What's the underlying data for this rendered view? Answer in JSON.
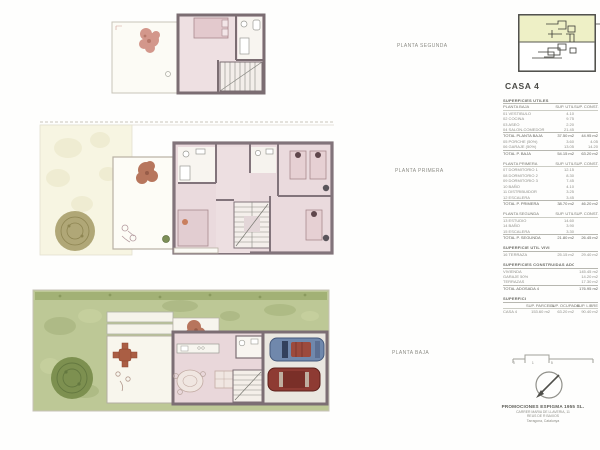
{
  "title": "CASA 4",
  "labels": {
    "planta_segunda": "PLANTA SEGUNDA",
    "planta_primera": "PLANTA PRIMERA",
    "planta_baja": "PLANTA BAJA"
  },
  "areas_table": {
    "sections": [
      {
        "rows": [
          {
            "t": "h",
            "c": [
              "SUPERFICIES UTILES CASA 4",
              "",
              ""
            ]
          },
          {
            "t": "c",
            "c": [
              "PLANTA BAJA",
              "SUP. UTIL",
              "SUP. CONST."
            ]
          },
          {
            "t": "r",
            "c": [
              "01 VESTIBULO",
              "4.10",
              ""
            ]
          },
          {
            "t": "r",
            "c": [
              "02 COCINA",
              "9.75",
              ""
            ]
          },
          {
            "t": "r",
            "c": [
              "03 ASEO",
              "2.20",
              ""
            ]
          },
          {
            "t": "r",
            "c": [
              "04 SALON-COMEDOR",
              "21.45",
              ""
            ]
          },
          {
            "t": "t",
            "c": [
              "TOTAL PLANTA BAJA",
              "37.50 m2",
              "44.95 m2"
            ]
          },
          {
            "t": "r",
            "c": [
              "05 PORCHE (50%)",
              "3.60",
              "4.05"
            ]
          },
          {
            "t": "r",
            "c": [
              "06 GARAJE (50%)",
              "13.05",
              "14.20"
            ]
          },
          {
            "t": "t",
            "c": [
              "TOTAL P. BAJA",
              "54.15 m2",
              "63.20 m2"
            ]
          }
        ]
      },
      {
        "rows": [
          {
            "t": "c",
            "c": [
              "PLANTA PRIMERA",
              "SUP. UTIL",
              "SUP. CONST."
            ]
          },
          {
            "t": "r",
            "c": [
              "07 DORMITORIO 1",
              "12.15",
              ""
            ]
          },
          {
            "t": "r",
            "c": [
              "08 DORMITORIO 2",
              "8.30",
              ""
            ]
          },
          {
            "t": "r",
            "c": [
              "09 DORMITORIO 3",
              "7.45",
              ""
            ]
          },
          {
            "t": "r",
            "c": [
              "10 BAÑO",
              "4.10",
              ""
            ]
          },
          {
            "t": "r",
            "c": [
              "11 DISTRIBUIDOR",
              "3.25",
              ""
            ]
          },
          {
            "t": "r",
            "c": [
              "12 ESCALERA",
              "3.45",
              ""
            ]
          },
          {
            "t": "t",
            "c": [
              "TOTAL P. PRIMERA",
              "38.70 m2",
              "46.20 m2"
            ]
          }
        ]
      },
      {
        "rows": [
          {
            "t": "c",
            "c": [
              "PLANTA SEGUNDA",
              "SUP. UTIL",
              "SUP. CONST."
            ]
          },
          {
            "t": "r",
            "c": [
              "13 ESTUDIO",
              "14.60",
              ""
            ]
          },
          {
            "t": "r",
            "c": [
              "14 BAÑO",
              "3.90",
              ""
            ]
          },
          {
            "t": "r",
            "c": [
              "15 ESCALERA",
              "3.30",
              ""
            ]
          },
          {
            "t": "t",
            "c": [
              "TOTAL P. SEGUNDA",
              "21.80 m2",
              "26.45 m2"
            ]
          }
        ]
      },
      {
        "rows": [
          {
            "t": "h",
            "c": [
              "SUPERFICIE UTIL VIVIENDA",
              "",
              ""
            ]
          },
          {
            "t": "r",
            "c": [
              "16 TERRAZA",
              "25.15 m2",
              "29.40 m2"
            ]
          }
        ]
      },
      {
        "rows": [
          {
            "t": "h",
            "c": [
              "SUPERFICIES CONSTRUIDAS ADOSADA 4",
              ""
            ]
          },
          {
            "t": "r",
            "c": [
              "VIVIENDA",
              "145.45 m2"
            ]
          },
          {
            "t": "r",
            "c": [
              "GARAJE 50%",
              "14.20 m2"
            ]
          },
          {
            "t": "r",
            "c": [
              "TERRAZAS",
              "17.30 m2"
            ]
          },
          {
            "t": "t",
            "c": [
              "TOTAL ADOSADA 4",
              "176.95 m2"
            ]
          }
        ]
      },
      {
        "rows": [
          {
            "t": "h",
            "c": [
              "SUPERFICIE DE LA PARCELA 4",
              "",
              "",
              ""
            ]
          },
          {
            "t": "c",
            "c": [
              "",
              "SUP. PARCELA",
              "SUP. OCUPADA",
              "SUP. LIBRE"
            ]
          },
          {
            "t": "r",
            "c": [
              "CASA 4",
              "153.60 m2",
              "63.20 m2",
              "90.40 m2"
            ]
          }
        ]
      }
    ]
  },
  "scale_bar": {
    "numbers": "0 1 5"
  },
  "company": {
    "name": "PROMOCIONES ESPIGMA 1955 SL.",
    "address_lines": [
      "CARRER MARIA DE LLAVERIA, 11",
      "REUS DE R BAIXOS",
      "Tarragona, Catalunya"
    ]
  },
  "colors": {
    "keyplan_highlight": "#eef0c6",
    "wall": "#7c6e74",
    "floor_pink": "#e9d7da",
    "garden_green": "#bdc896",
    "hedge_green": "#a2b175",
    "tree_olive": "#a79e6b",
    "tree_dark": "#7d9050",
    "plant_red": "#b26b51",
    "car_blue": "#7088ac",
    "car_red": "#8e3b33"
  }
}
